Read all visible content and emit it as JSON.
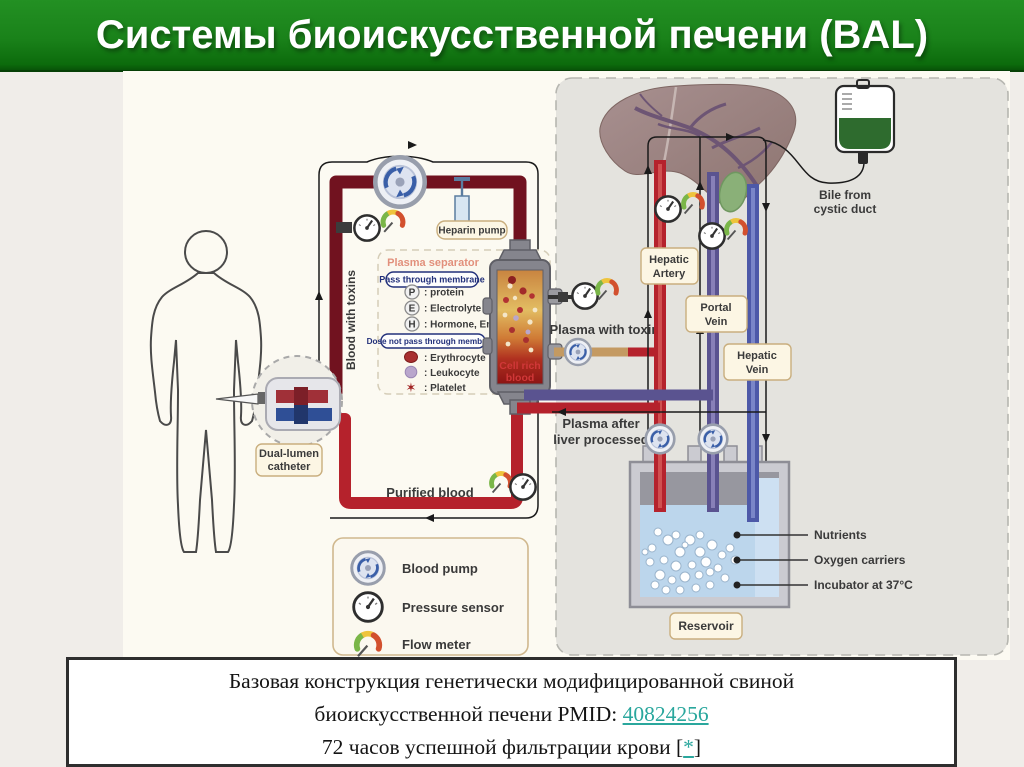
{
  "title": {
    "text": "Системы биоискусственной печени (BAL)"
  },
  "theme": {
    "title_bg": "#1a821a",
    "title_text": "#ffffff",
    "page_bg": "#f0ede9",
    "diagram_bg": "#fcfaf2",
    "panel_bg": "#e4e3de",
    "blood_toxins_color": "#71121f",
    "purified_color": "#b5222c",
    "plasma_color": "#c49a62",
    "portal_color": "#5a5390",
    "vein_color": "#4d59a8",
    "link_color": "#2aa79d"
  },
  "diagram": {
    "labels": {
      "heparin_pump": "Heparin pump",
      "plasma_separator": "Plasma separator",
      "pass_through": "Pass through membrane",
      "p_letter": "P",
      "p_text": ": protein",
      "e_letter": "E",
      "e_text": ": Electrolyte",
      "h_letter": "H",
      "h_text": ": Hormone, Enzyme",
      "not_pass": "Dose not pass through membrane",
      "erythrocyte": ": Erythrocyte",
      "leukocyte": ": Leukocyte",
      "platelet": ": Platelet",
      "platelet_glyph": "✶",
      "blood_with_toxins": "Blood with toxins",
      "dual_lumen_1": "Dual-lumen",
      "dual_lumen_2": "catheter",
      "purified_blood": "Purified blood",
      "plasma_with_toxins": "Plasma with toxins",
      "cell_rich_1": "Cell rich",
      "cell_rich_2": "blood",
      "hepatic_artery_1": "Hepatic",
      "hepatic_artery_2": "Artery",
      "portal_vein_1": "Portal",
      "portal_vein_2": "Vein",
      "hepatic_vein_1": "Hepatic",
      "hepatic_vein_2": "Vein",
      "bile_1": "Bile from",
      "bile_2": "cystic duct",
      "plasma_after_1": "Plasma after",
      "plasma_after_2": "liver processed",
      "nutrients": "Nutrients",
      "oxygen_carriers": "Oxygen carriers",
      "incubator": "Incubator at 37°C",
      "reservoir": "Reservoir",
      "legend_blood_pump": "Blood pump",
      "legend_pressure_sensor": "Pressure sensor",
      "legend_flow_meter": "Flow meter"
    }
  },
  "caption": {
    "line1": "Базовая конструкция генетически модифицированной свиной",
    "line2_prefix": "биоискусственной печени PMID: ",
    "line2_link": "40824256",
    "line3_prefix": "72 часов успешной фильтрации крови [",
    "line3_link": "*",
    "line3_suffix": "]"
  }
}
